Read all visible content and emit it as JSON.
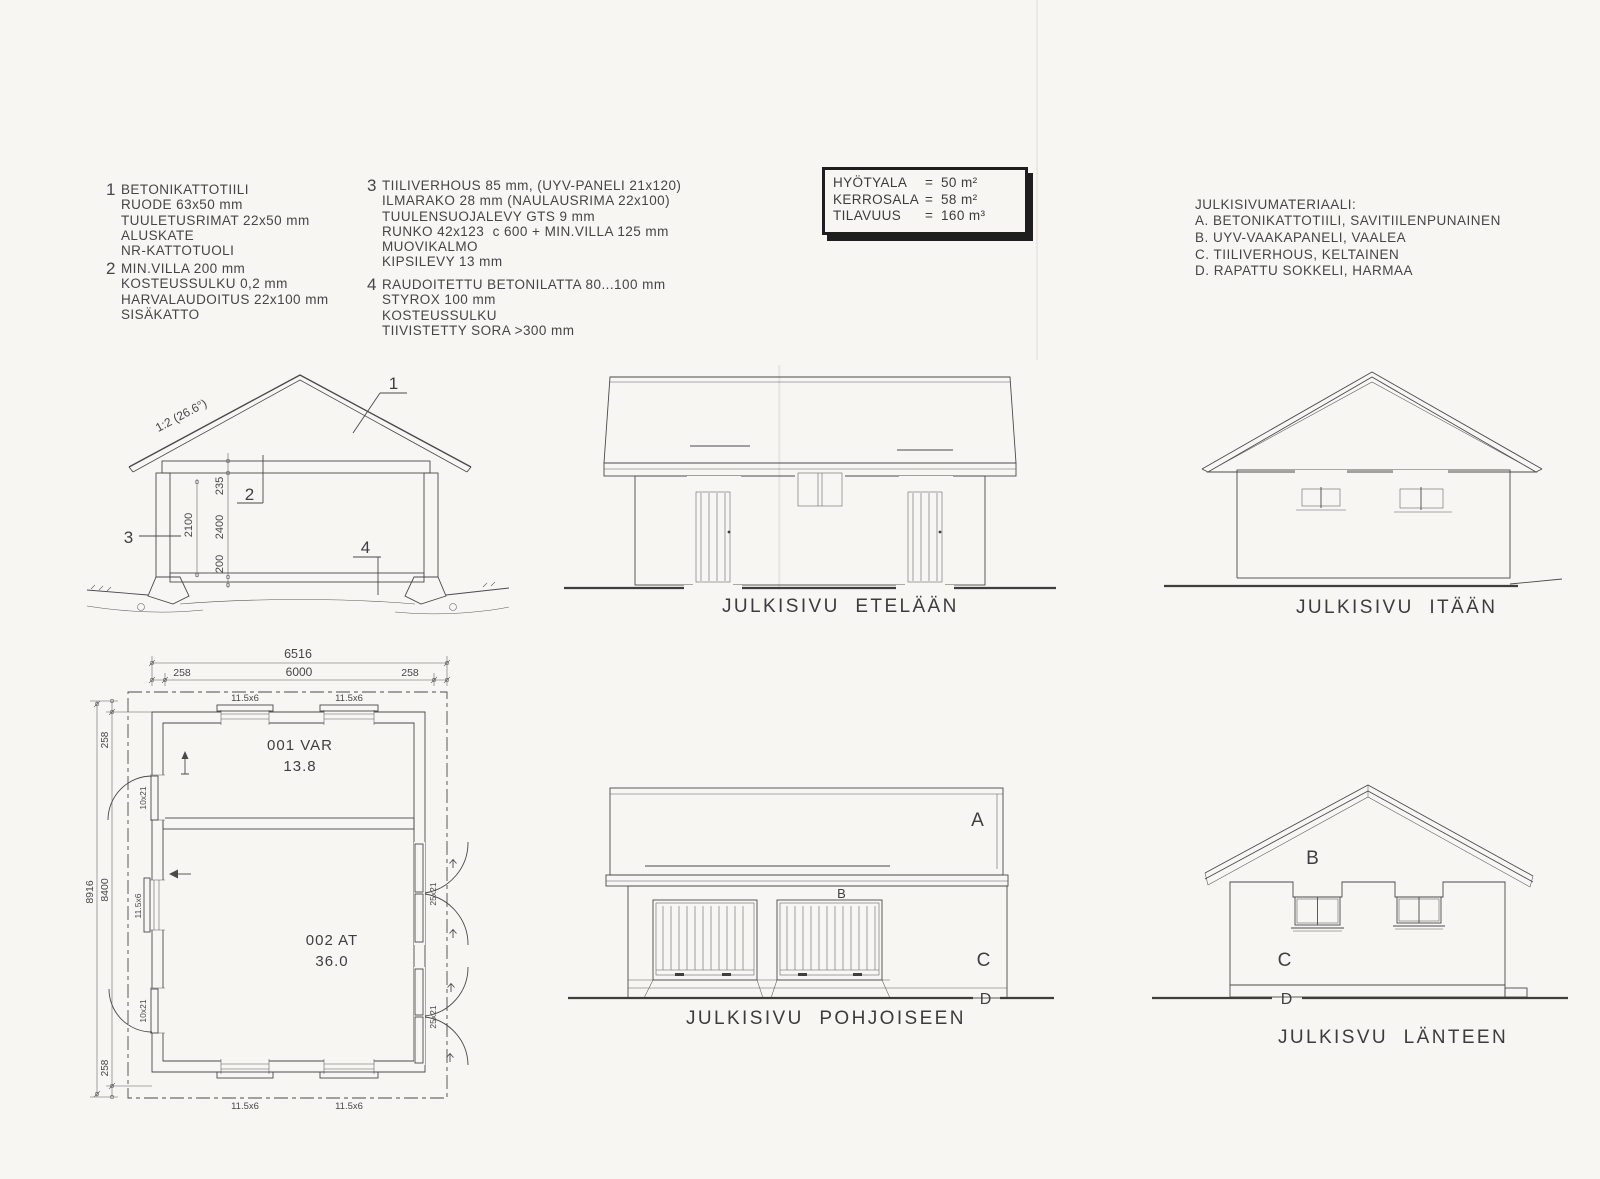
{
  "specs": {
    "item1": {
      "num": "1",
      "lines": [
        "BETONIKATTOTIILI",
        "RUODE 63x50 mm",
        "TUULETUSRIMAT 22x50 mm",
        "ALUSKATE",
        "NR-KATTOTUOLI"
      ]
    },
    "item2": {
      "num": "2",
      "lines": [
        "MIN.VILLA 200 mm",
        "KOSTEUSSULKU 0,2 mm",
        "HARVALAUDOITUS 22x100 mm",
        "SISÄKATTO"
      ]
    },
    "item3": {
      "num": "3",
      "lines": [
        "TIILIVERHOUS 85 mm, (UYV-PANELI 21x120)",
        "ILMARAKO 28 mm (NAULAUSRIMA 22x100)",
        "TUULENSUOJALEVY GTS 9 mm",
        "RUNKO 42x123  c 600 + MIN.VILLA 125 mm",
        "MUOVIKALMO",
        "KIPSILEVY 13 mm"
      ]
    },
    "item4": {
      "num": "4",
      "lines": [
        "RAUDOITETTU BETONILATTA 80...100 mm",
        "STYROX 100 mm",
        "KOSTEUSSULKU",
        "TIIVISTETTY SORA >300 mm"
      ]
    }
  },
  "info_box": {
    "eq": "=",
    "rows": [
      {
        "label": "HYÖTYALA",
        "value": "50 m²"
      },
      {
        "label": "KERROSALA",
        "value": "58 m²"
      },
      {
        "label": "TILAVUUS",
        "value": "160 m³"
      }
    ]
  },
  "materials": {
    "title": "JULKISIVUMATERIAALI:",
    "lines": [
      "A. BETONIKATTOTIILI, SAVITIILENPUNAINEN",
      "B. UYV-VAAKAPANELI, VAALEA",
      "C. TIILIVERHOUS, KELTAINEN",
      "D. RAPATTU SOKKELI, HARMAA"
    ]
  },
  "section": {
    "slope_label": "1:2 (26.6°)",
    "callouts": [
      "1",
      "2",
      "3",
      "4"
    ],
    "dim_235": "235",
    "dim_2400": "2400",
    "dim_200": "200",
    "dim_2100": "2100"
  },
  "plan": {
    "dim_total_w": "6516",
    "dim_w_left": "258",
    "dim_w_mid": "6000",
    "dim_w_right": "258",
    "dim_total_h": "8916",
    "dim_h_top": "258",
    "dim_h_mid": "8400",
    "dim_h_bot": "258",
    "room1_name": "001 VAR",
    "room1_area": "13.8",
    "room2_name": "002 AT",
    "room2_area": "36.0",
    "window_label": "11.5x6",
    "door_left_label": "10x21",
    "door_right_label": "25x21"
  },
  "elevations": {
    "south": {
      "caption": "JULKISIVU ETELÄÄN"
    },
    "east": {
      "caption": "JULKISIVU ITÄÄN"
    },
    "north": {
      "caption": "JULKISIVU POHJOISEEN",
      "label_a": "A",
      "label_b": "B",
      "label_c": "C",
      "label_d": "D"
    },
    "west": {
      "caption": "JULKISVU LÄNTEEN",
      "label_b": "B",
      "label_c": "C",
      "label_d": "D"
    }
  }
}
